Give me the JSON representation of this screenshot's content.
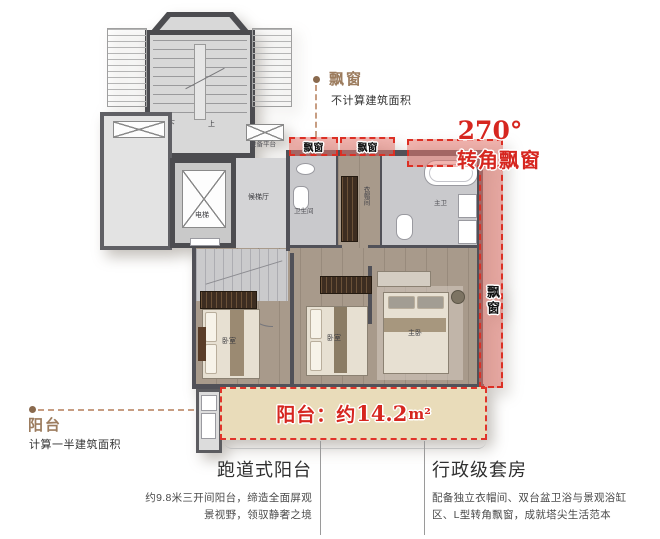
{
  "plan": {
    "stair_down": "下",
    "stair_up": "上",
    "equipment_platform": "设备平台",
    "elevator": "电梯",
    "elevator_hall": "候梯厅",
    "bathroom": "卫生间",
    "cloakroom": "衣帽间",
    "master_bath": "主卫",
    "bedroom_left": "卧室",
    "bedroom_middle": "卧室",
    "master_bedroom": "主卧",
    "bay_box_left": "飘窗",
    "bay_box_right": "飘窗",
    "bay_side": "飘窗"
  },
  "callouts": {
    "top_bay": {
      "title": "飘窗",
      "note": "不计算建筑面积"
    },
    "corner_bay": {
      "degrees": "270°",
      "label": "转角飘窗"
    },
    "balcony": {
      "title": "阳台",
      "note": "计算一半建筑面积"
    },
    "balcony_tag": {
      "prefix": "阳台：约",
      "value": "14.2",
      "unit": "m²"
    }
  },
  "sections": {
    "left": {
      "heading": "跑道式阳台",
      "line1": "约9.8米三开间阳台，缔造全面屏观",
      "line2": "景视野，领驭静奢之境"
    },
    "right": {
      "heading": "行政级套房",
      "line1": "配备独立衣帽间、双台盆卫浴与景观浴缸",
      "line2": "区、L型转角飘窗，成就塔尖生活范本"
    }
  },
  "colors": {
    "accent_red": "#d6261f",
    "dash_red": "#dc2f24",
    "annotation_brown": "#9c7c5e",
    "balcony_fill": "#e9dcba",
    "bay_fill": "#edaca6"
  }
}
